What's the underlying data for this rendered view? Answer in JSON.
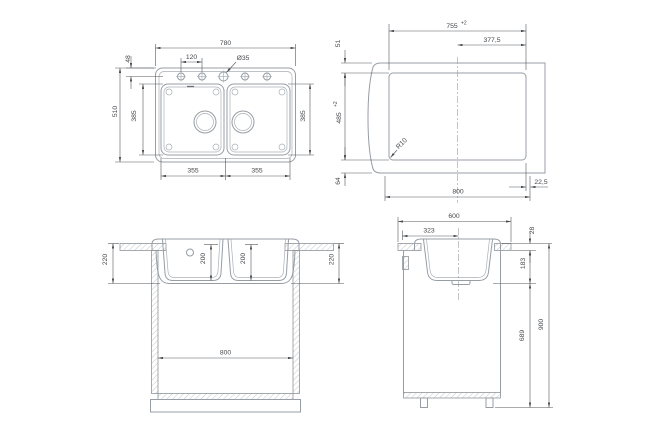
{
  "colors": {
    "background": "#ffffff",
    "geometry_line": "#979da4",
    "dimension_line": "#55585c",
    "text": "#46484c"
  },
  "plan": {
    "overall_width": "780",
    "hole_pitch": "120",
    "hole_diameter": "Ø35",
    "edge_to_hole": "48",
    "overall_depth": "510",
    "bowl_length_left": "385",
    "bowl_length_right": "385",
    "bowl_width_left": "355",
    "bowl_width_right": "355"
  },
  "cutout": {
    "width": "755",
    "width_tol": "+2",
    "center_to_edge": "377,5",
    "front_gap": "51",
    "depth": "485",
    "depth_tol": "+2",
    "rear_gap": "64",
    "corner_radius": "R10",
    "cabinet_width": "800",
    "side_gap": "22,5"
  },
  "front_section": {
    "rim_to_bottom_left": "220",
    "bowl_depth_left": "200",
    "bowl_depth_right": "200",
    "rim_to_bottom_right": "220",
    "cabinet_inner_width": "800"
  },
  "side_section": {
    "counter_depth": "600",
    "bowl_opening": "323",
    "counter_thickness": "28",
    "bowl_under_depth": "183",
    "clearance_height": "689",
    "floor_to_counter": "900"
  }
}
